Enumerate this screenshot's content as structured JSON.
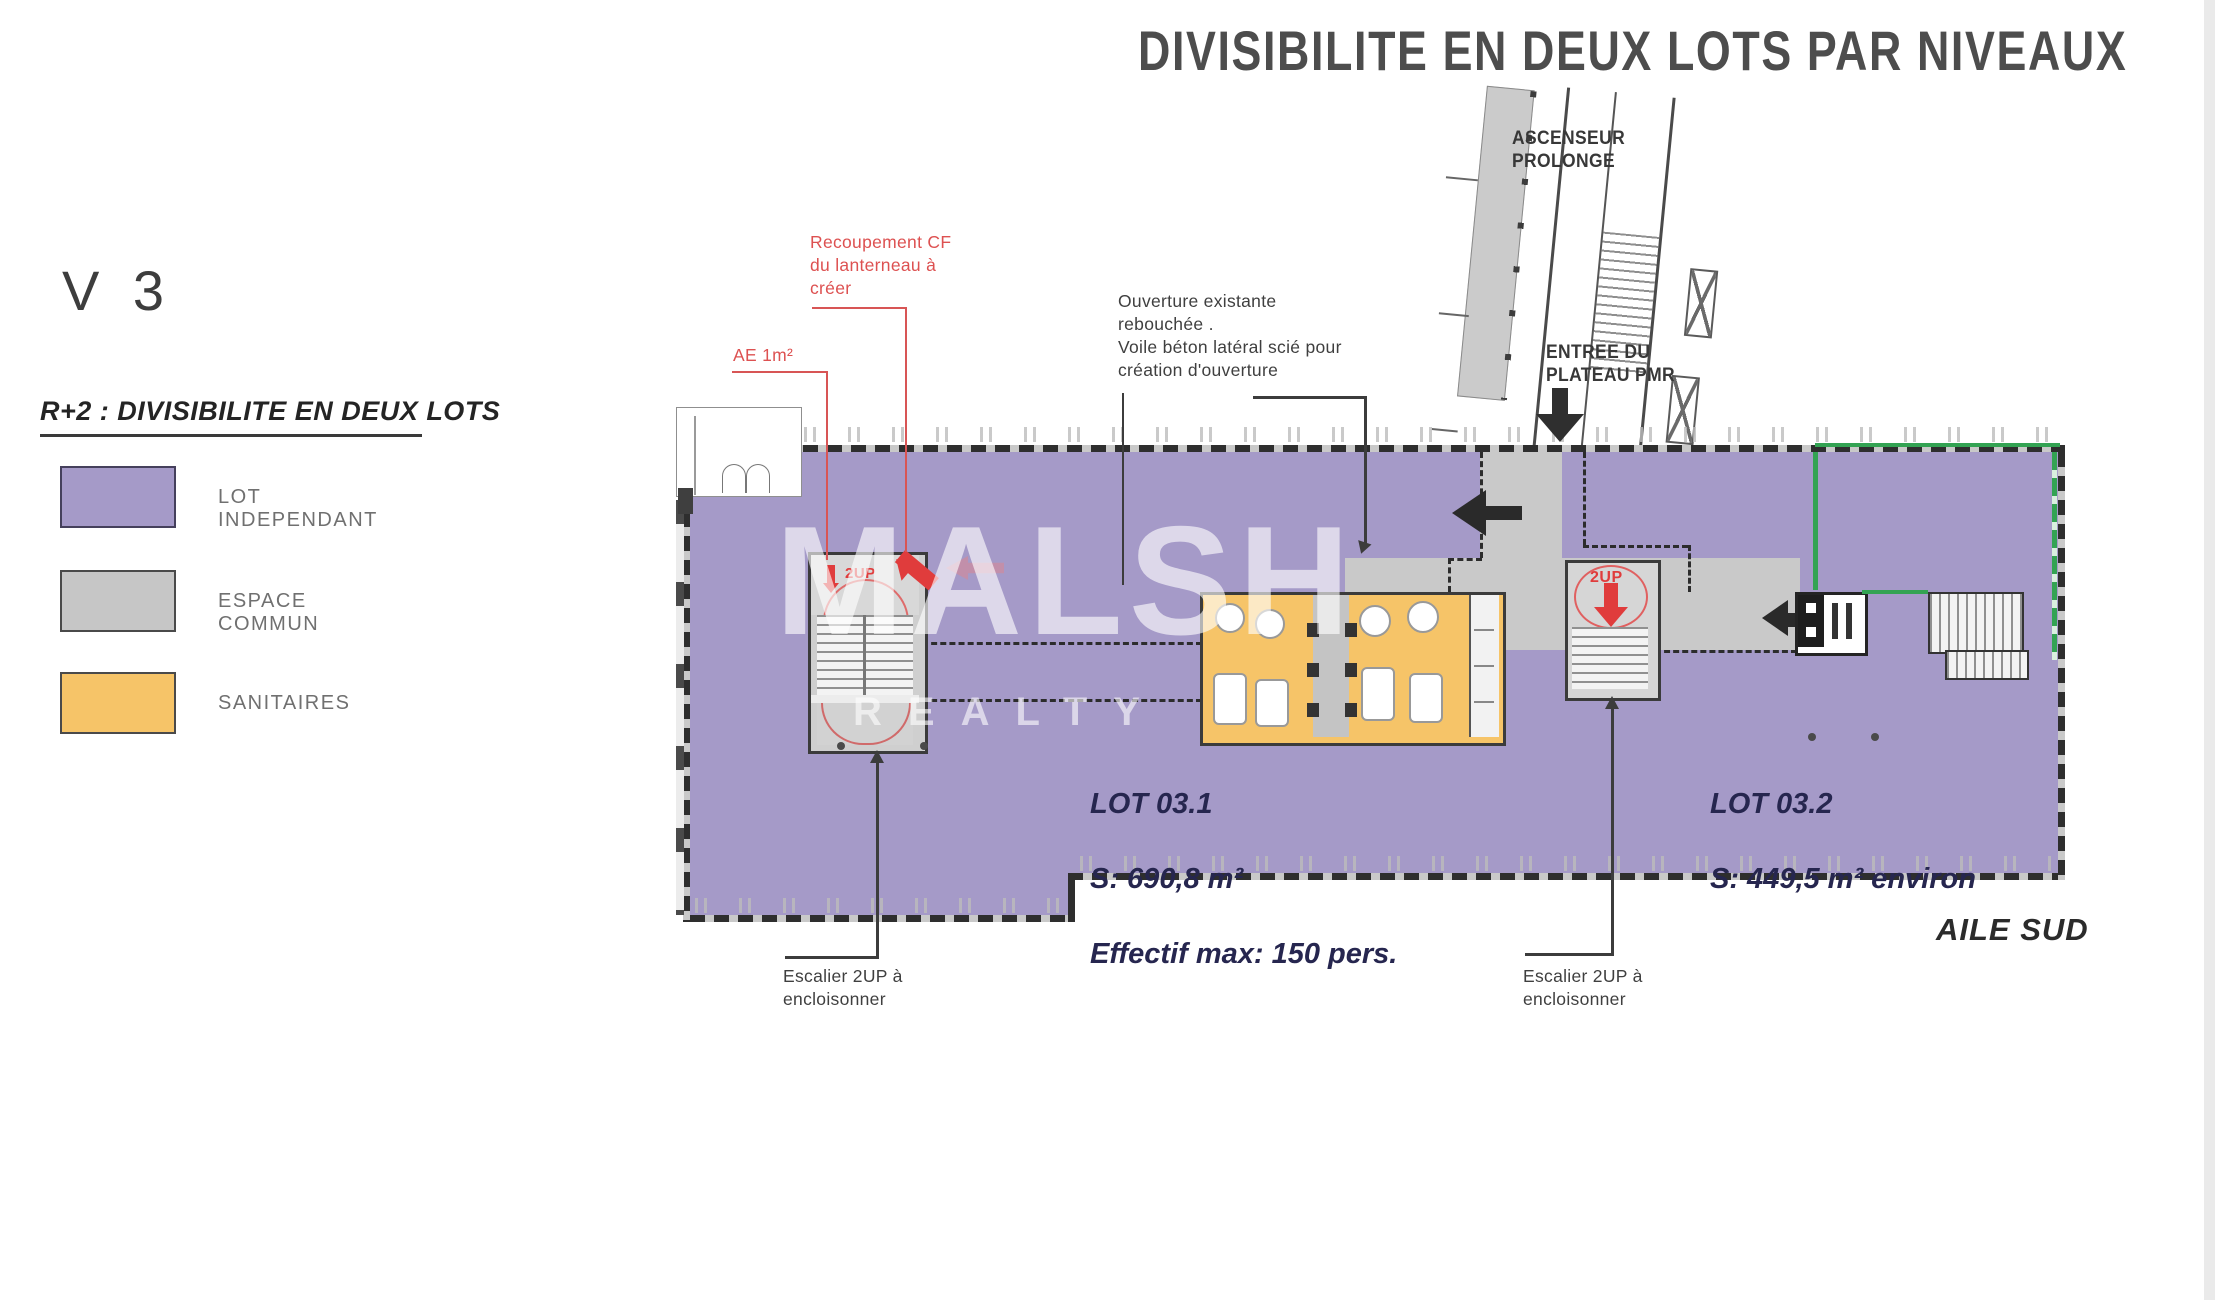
{
  "title": "DIVISIBILITE EN DEUX LOTS PAR NIVEAUX",
  "version": "V 3",
  "section_heading": "R+2 : DIVISIBILITE EN DEUX LOTS",
  "legend": {
    "items": [
      {
        "label": "LOT INDEPENDANT",
        "color": "#a59ac8"
      },
      {
        "label": "ESPACE COMMUN",
        "color": "#c6c6c6"
      },
      {
        "label": "SANITAIRES",
        "color": "#f6c468"
      }
    ]
  },
  "annotations": {
    "recoupement": "Recoupement CF\ndu lanterneau à\ncréer",
    "ae": "AE 1m²",
    "ouverture": "Ouverture existante\nrebouchée .\nVoile béton latéral scié pour\ncréation d'ouverture",
    "ascenseur": "ASCENSEUR\nPROLONGE",
    "entree": "ENTREE DU\nPLATEAU PMR",
    "escalier": "Escalier 2UP à\nencloisonner",
    "stair_marker": "2UP"
  },
  "lots": {
    "lot1": {
      "name": "LOT 03.1",
      "surface": "S: 690,8 m²",
      "capacity": "Effectif max: 150 pers."
    },
    "lot2": {
      "name": "LOT 03.2",
      "surface": "S: 449,5 m² environ"
    }
  },
  "wing": "AILE SUD",
  "watermark": {
    "line1": "MALSH",
    "line2": "REALTY"
  },
  "colors": {
    "lot_independant": "#a59ac8",
    "espace_commun": "#c6c6c6",
    "sanitaires": "#f6c468",
    "wall": "#2e2e2e",
    "red_annotation": "#dd4b4b",
    "green_existing": "#33a353",
    "lot_text_navy": "#26264f",
    "title_gray": "#4d4d4d",
    "label_gray": "#707070"
  }
}
